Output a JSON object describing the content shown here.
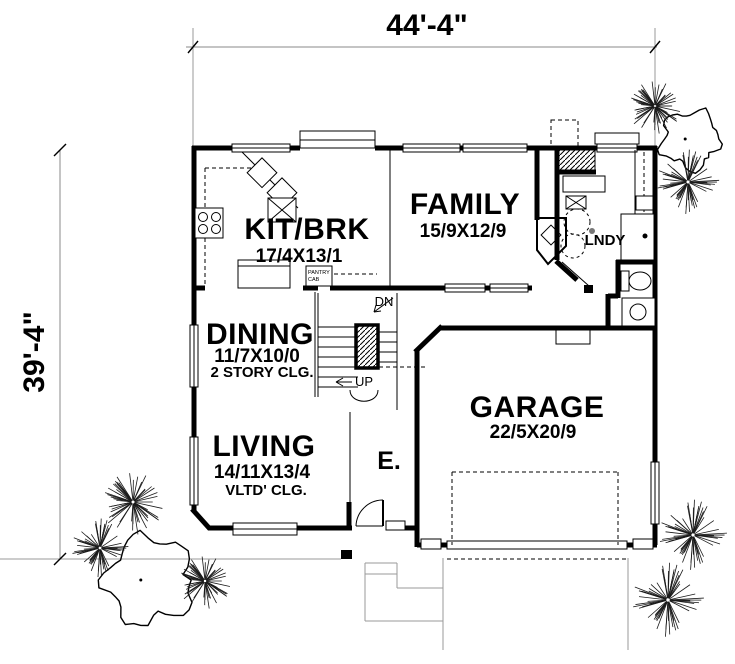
{
  "plan": {
    "dimensions": {
      "width_label": "44'-4\"",
      "height_label": "39'-4\""
    },
    "rooms": {
      "kitchen": {
        "name": "KIT/BRK",
        "size": "17/4X13/1"
      },
      "family": {
        "name": "FAMILY",
        "size": "15/9X12/9"
      },
      "dining": {
        "name": "DINING",
        "size": "11/7X10/0",
        "note": "2 STORY CLG."
      },
      "living": {
        "name": "LIVING",
        "size": "14/11X13/4",
        "note": "VLTD' CLG."
      },
      "garage": {
        "name": "GARAGE",
        "size": "22/5X20/9"
      },
      "laundry": {
        "name": "LNDY"
      },
      "entry": {
        "name": "E."
      }
    },
    "stairs": {
      "down": "DN",
      "up": "UP"
    },
    "pantry": {
      "line1": "PANTRY",
      "line2": "CAB"
    },
    "colors": {
      "wall": "#000000",
      "site_line": "#9a9a9a",
      "background": "#ffffff"
    }
  }
}
